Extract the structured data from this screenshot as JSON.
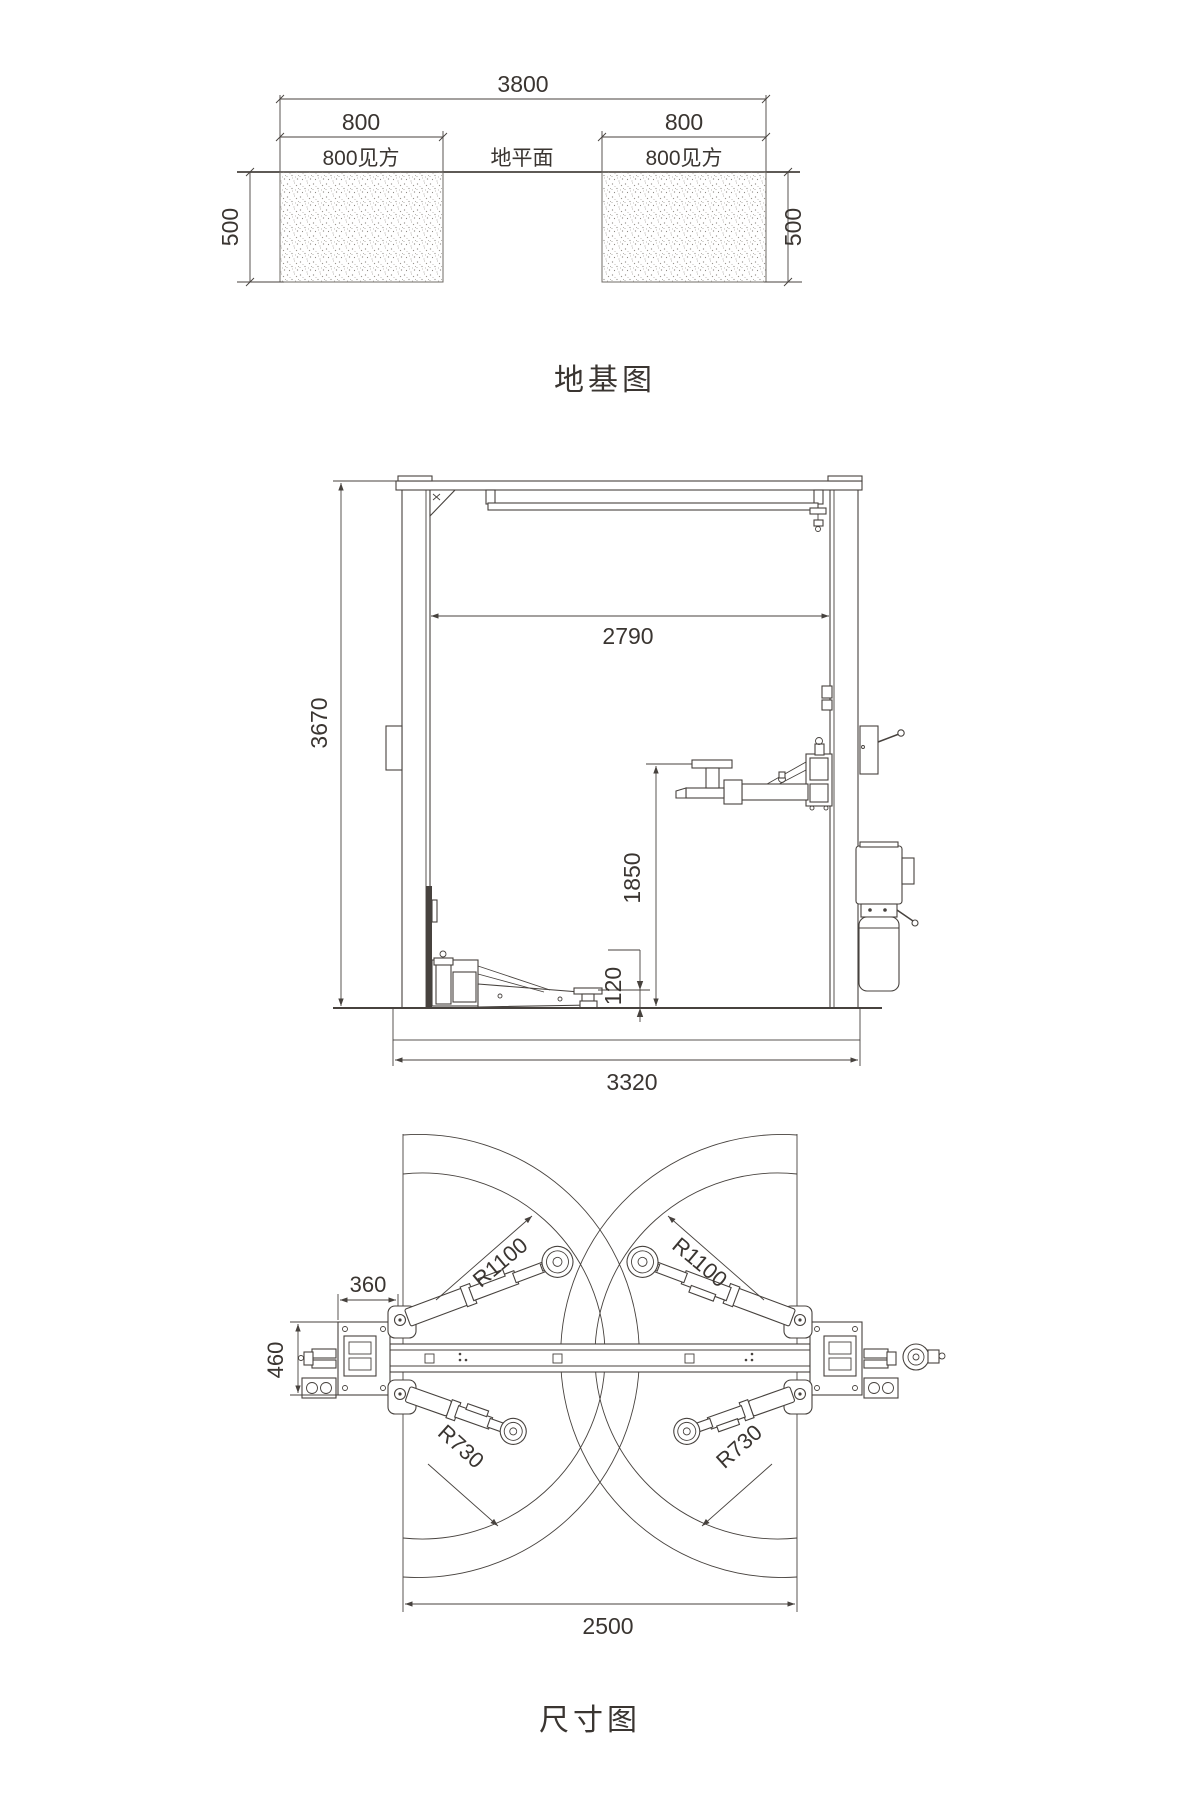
{
  "colors": {
    "line": "#47423e",
    "text": "#3a3531",
    "background": "#ffffff"
  },
  "foundation_view": {
    "title": "地基图",
    "overall_width": "3800",
    "block_width_left": "800",
    "block_width_right": "800",
    "block_square_left": "800见方",
    "ground_level_label": "地平面",
    "block_square_right": "800见方",
    "depth_left": "500",
    "depth_right": "500"
  },
  "front_view": {
    "clear_width": "2790",
    "overall_height": "3670",
    "lift_height": "1850",
    "min_pad_height": "120",
    "base_width": "3320"
  },
  "plan_view": {
    "title": "尺寸图",
    "long_arm_radius_left": "R1100",
    "long_arm_radius_right": "R1100",
    "short_arm_radius_left": "R730",
    "short_arm_radius_right": "R730",
    "column_offset": "360",
    "baseplate_depth": "460",
    "drive_through_width": "2500"
  }
}
